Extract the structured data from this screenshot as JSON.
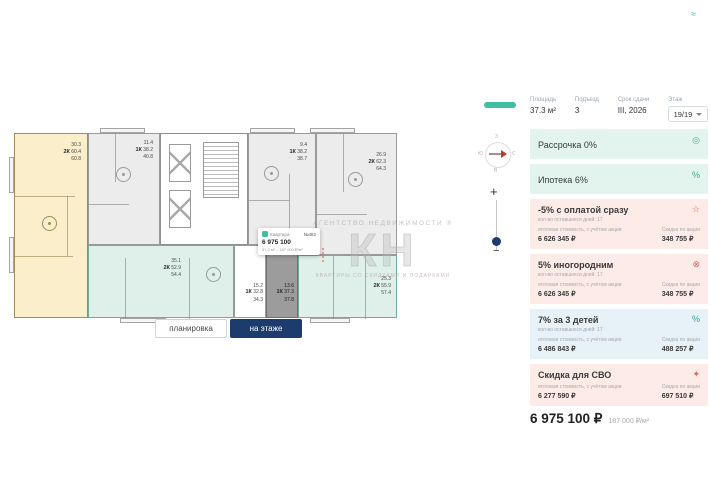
{
  "page": {
    "logo_mark": "≈"
  },
  "plan": {
    "compass": {
      "top": "З",
      "right": "С",
      "bottom": "В",
      "left": "Ю"
    },
    "zoom": {
      "plus": "+",
      "minus": "−"
    },
    "watermark": {
      "line1": "АГЕНТСТВО НЕДВИЖИМОСТИ ®",
      "big": "КН",
      "line2": "КВАРТИРЫ СО СКИДКАМИ И ПОДАРКАМИ"
    },
    "units": [
      {
        "room": "30.3",
        "type": "2К",
        "area": "60.4",
        "total": "60.8"
      },
      {
        "room": "11.4",
        "type": "1К",
        "area": "38.2",
        "total": "40.8"
      },
      {
        "room": "9.4",
        "type": "1К",
        "area": "38.2",
        "total": "38.7"
      },
      {
        "room": "26.9",
        "type": "2К",
        "area": "62.3",
        "total": "64.3"
      },
      {
        "room": "35.1",
        "type": "2К",
        "area": "52.9",
        "total": "54.4"
      },
      {
        "room": "15.2",
        "type": "1К",
        "area": "32.8",
        "total": "34.3"
      },
      {
        "room": "13.6",
        "type": "1К",
        "area": "37.3",
        "total": "37.8"
      },
      {
        "room": "25.3",
        "type": "2К",
        "area": "55.9",
        "total": "57.4"
      }
    ],
    "tooltip": {
      "label": "Квартира",
      "number": "№482",
      "price": "6 975 100",
      "meta": "37.3 м² – 187 000 ₽/м²"
    },
    "tabs": {
      "plan": "планировка",
      "floor": "на этаже"
    }
  },
  "sidebar": {
    "header": {
      "area_label": "Площадь",
      "area_value": "37.3 м²",
      "entrance_label": "Подъезд",
      "entrance_value": "3",
      "deadline_label": "Срок сдачи",
      "deadline_value": "III, 2026",
      "floor_label": "Этаж",
      "floor_value": "19/19"
    },
    "rows": [
      {
        "title": "Рассрочка 0%",
        "icon_glyph": "◎"
      },
      {
        "title": "Ипотека 6%",
        "icon_glyph": "%"
      },
      {
        "title": "-5% с оплатой сразу",
        "days": "кол-во оставшихся дней: 17",
        "price_label": "итоговая стоимость, с учётом акции",
        "price": "6 626 345 ₽",
        "discount_label": "Скидка по акции",
        "discount": "348 755 ₽",
        "icon_glyph": "☆"
      },
      {
        "title": "5% иногородним",
        "days": "кол-во оставшихся дней: 17",
        "price_label": "итоговая стоимость, с учётом акции",
        "price": "6 626 345 ₽",
        "discount_label": "Скидка по акции",
        "discount": "348 755 ₽",
        "icon_glyph": "⊗"
      },
      {
        "title": "7% за 3 детей",
        "days": "кол-во оставшихся дней: 17",
        "price_label": "итоговая стоимость, с учётом акции",
        "price": "6 486 843 ₽",
        "discount_label": "Скидка по акции",
        "discount": "488 257 ₽",
        "icon_glyph": "%"
      },
      {
        "title": "Скидка для СВО",
        "price_label": "итоговая стоимость, с учётом акции",
        "price": "6 277 590 ₽",
        "discount_label": "Скидка по акции",
        "discount": "697 510 ₽",
        "icon_glyph": "✦"
      }
    ],
    "total": {
      "price": "6 975 100 ₽",
      "per_m2": "187 000 ₽/м²"
    }
  },
  "colors": {
    "accent_green": "#3fbf9f",
    "navy": "#1d3c6e",
    "red": "#d9655c",
    "teal_unit": "#def0e9",
    "yellow_unit": "#faefca"
  }
}
